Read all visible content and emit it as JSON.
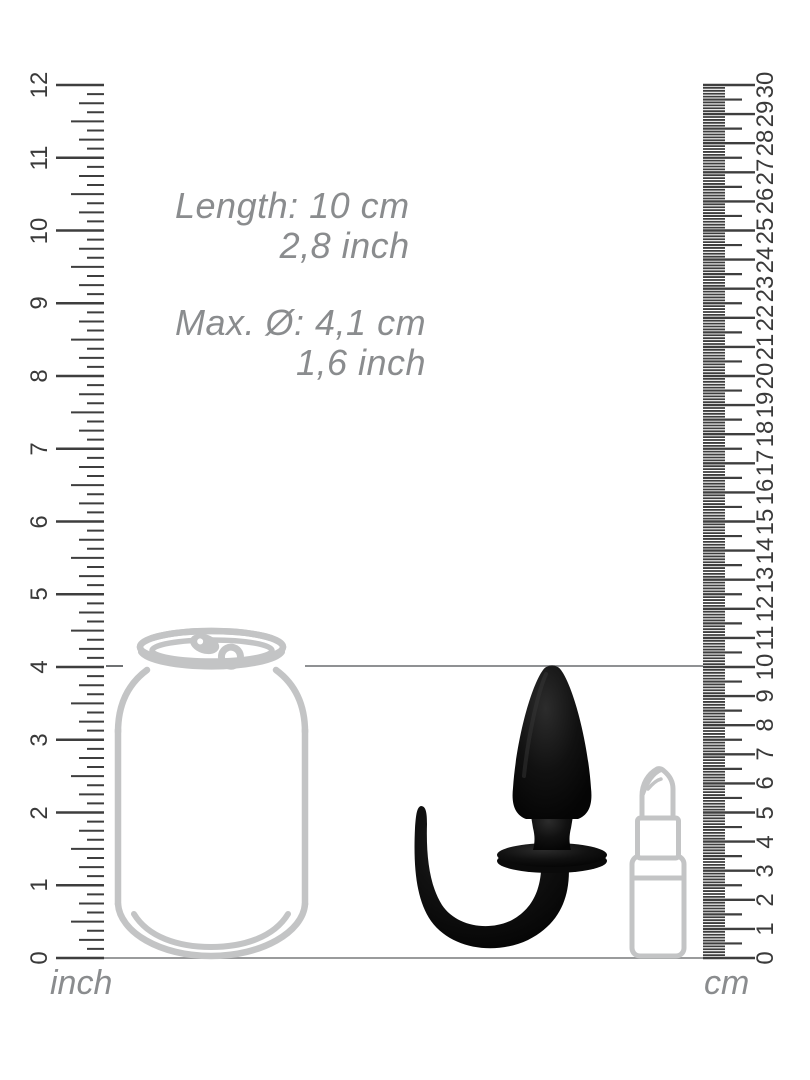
{
  "page": {
    "background": "#ffffff"
  },
  "specs": {
    "length": {
      "metric": "Length: 10 cm",
      "imperial": "2,8 inch"
    },
    "diameter": {
      "metric": "Max. Ø: 4,1 cm",
      "imperial": "1,6 inch"
    }
  },
  "rulers": {
    "inch": {
      "unit": "inch",
      "numbers": [
        "0",
        "1",
        "2",
        "3",
        "4",
        "5",
        "6",
        "7",
        "8",
        "9",
        "10",
        "11",
        "12"
      ],
      "subdivisions_per_unit": 8
    },
    "cm": {
      "unit": "cm",
      "numbers": [
        "0",
        "1",
        "2",
        "3",
        "4",
        "5",
        "6",
        "7",
        "8",
        "9",
        "10",
        "11",
        "12",
        "13",
        "14",
        "15",
        "16",
        "17",
        "18",
        "19",
        "20",
        "21",
        "22",
        "23",
        "24",
        "25",
        "26",
        "27",
        "28",
        "29",
        "30"
      ],
      "subdivisions_per_unit": 10
    }
  },
  "illustrations": {
    "can": "soda-can-outline",
    "product": "black-plug-with-tail",
    "lipstick": "lipstick-outline"
  },
  "colors": {
    "tick_dark": "#3e3e3e",
    "label_gray": "#8a8c8e",
    "outline_gray": "#c3c4c5",
    "line_gray": "#8f9193",
    "product_black": "#0b0b0b"
  }
}
